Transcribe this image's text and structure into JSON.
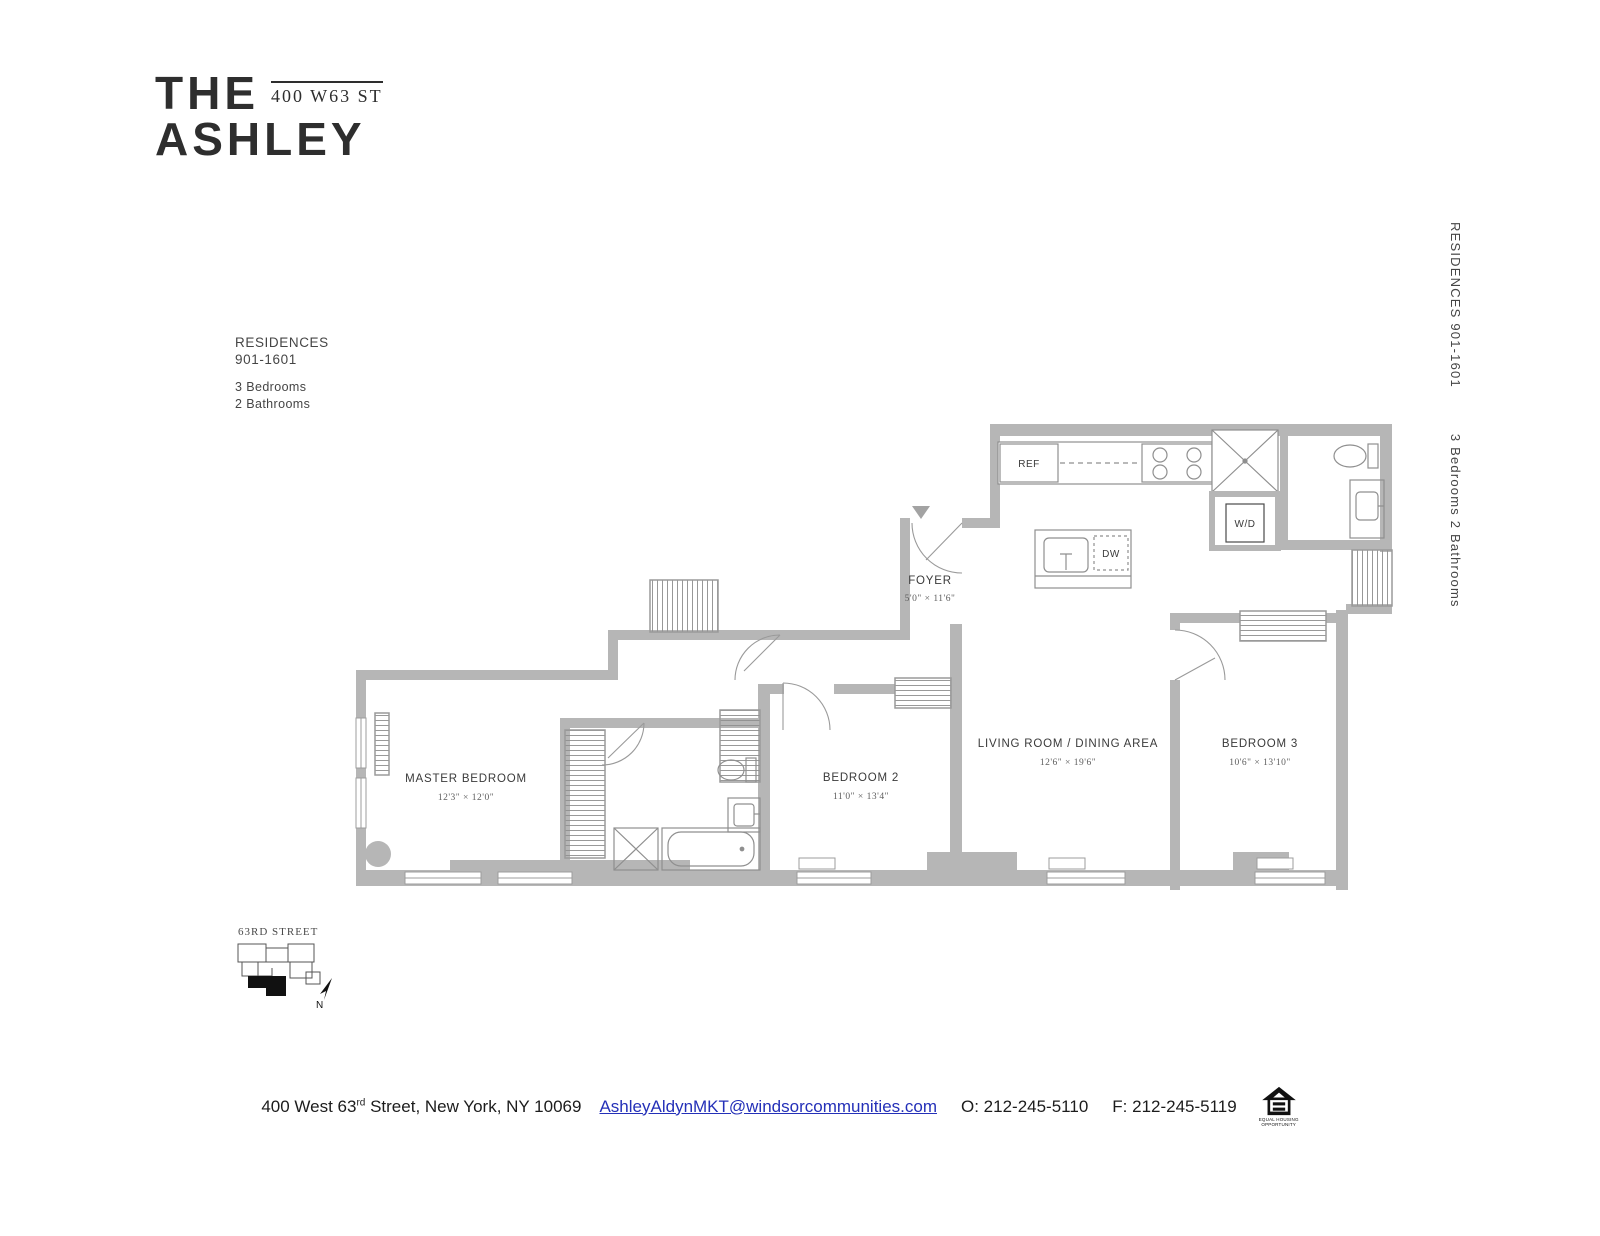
{
  "brand": {
    "name_line1": "THE",
    "name_line2": "ASHLEY",
    "address_badge": "400 W63 ST"
  },
  "residence_info": {
    "title": "RESIDENCES",
    "range": "901-1601",
    "bedrooms": "3 Bedrooms",
    "bathrooms": "2 Bathrooms"
  },
  "side_label": {
    "residences": "RESIDENCES  901-1601",
    "beds_baths": "3 Bedrooms  2 Bathrooms"
  },
  "floorplan": {
    "master": {
      "name": "MASTER BEDROOM",
      "dims": "12'3\" × 12'0\""
    },
    "bedroom2": {
      "name": "BEDROOM 2",
      "dims": "11'0\" × 13'4\""
    },
    "bedroom3": {
      "name": "BEDROOM 3",
      "dims": "10'6\" × 13'10\""
    },
    "living": {
      "name": "LIVING ROOM / DINING AREA",
      "dims": "12'6\" × 19'6\""
    },
    "foyer": {
      "name": "FOYER",
      "dims": "5'0\" × 11'6\""
    },
    "labels": {
      "ref": "REF",
      "dw": "DW",
      "wd": "W/D"
    }
  },
  "site_map": {
    "street": "63RD STREET",
    "compass": "N"
  },
  "footer": {
    "address_main": "400 West 63",
    "address_sup": "rd",
    "address_rest": " Street, New York, NY 10069",
    "email": "AshleyAldynMKT@windsorcommunities.com",
    "office_phone": "O: 212-245-5110",
    "fax_phone": "F: 212-245-5119",
    "eho_line1": "EQUAL HOUSING",
    "eho_line2": "OPPORTUNITY"
  },
  "colors": {
    "wall": "#b6b6b6",
    "ink": "#3d3d3d",
    "link": "#2430b8"
  }
}
